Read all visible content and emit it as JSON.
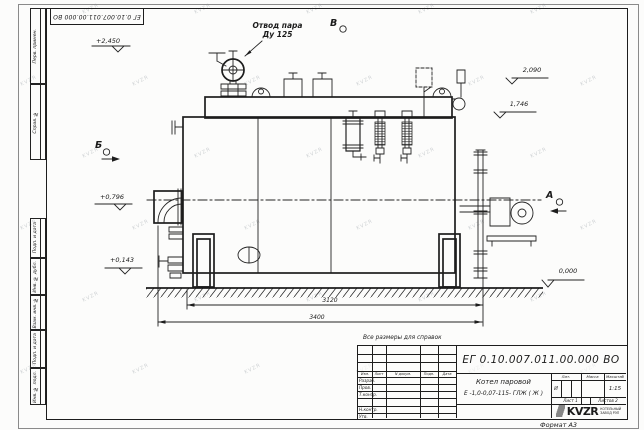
{
  "doc": {
    "number": "ЕГ 0.10.007.011.00.000  ВО",
    "title_line1": "Котел паровой",
    "title_line2": "Е -1,0-0,07-115- ГЛЖ ( Ж )",
    "note": "Все размеры для справок",
    "format": "Формат А3"
  },
  "titleblock": {
    "header": [
      "Изм.",
      "Лист",
      "N докум.",
      "Подп.",
      "Дата"
    ],
    "rows": [
      "Разраб.",
      "Пров.",
      "Т.контр.",
      "",
      "Н.контр.",
      "Утв."
    ],
    "lit_label": "Лит.",
    "lit_value": "И",
    "mass_label": "Масса",
    "scale_label": "Масштаб",
    "scale_value": "1:15",
    "sheet_text": "Лист 1",
    "sheets_text": "Листов 2",
    "logo_text": "KVZR",
    "logo_sub_line1": "КОТЕЛЬНЫЙ",
    "logo_sub_line2": "ЗАВОД РЭП"
  },
  "frame": {
    "side_labels_top": [
      {
        "text": "Перв. примен."
      },
      {
        "text": "Справ. №"
      }
    ],
    "side_labels_bottom": [
      {
        "text": "Подп. и дата"
      },
      {
        "text": "Инв. № дубл."
      },
      {
        "text": "Взам. инв. №"
      },
      {
        "text": "Подп. и дата"
      },
      {
        "text": "Инв. № подл."
      }
    ]
  },
  "annotations": {
    "steam_line1": "Отвод пара",
    "steam_line2": "Ду 125",
    "view_b": "Б",
    "view_v": "В",
    "view_a": "А",
    "levels": [
      {
        "text": "+2,450"
      },
      {
        "text": "2,090"
      },
      {
        "text": "1,746"
      },
      {
        "text": "+0,796"
      },
      {
        "text": "+0,143"
      },
      {
        "text": "0,000"
      }
    ],
    "dim_width_inner": "3120",
    "dim_width_overall": "3400"
  },
  "watermark": {
    "text": "KVZR"
  }
}
